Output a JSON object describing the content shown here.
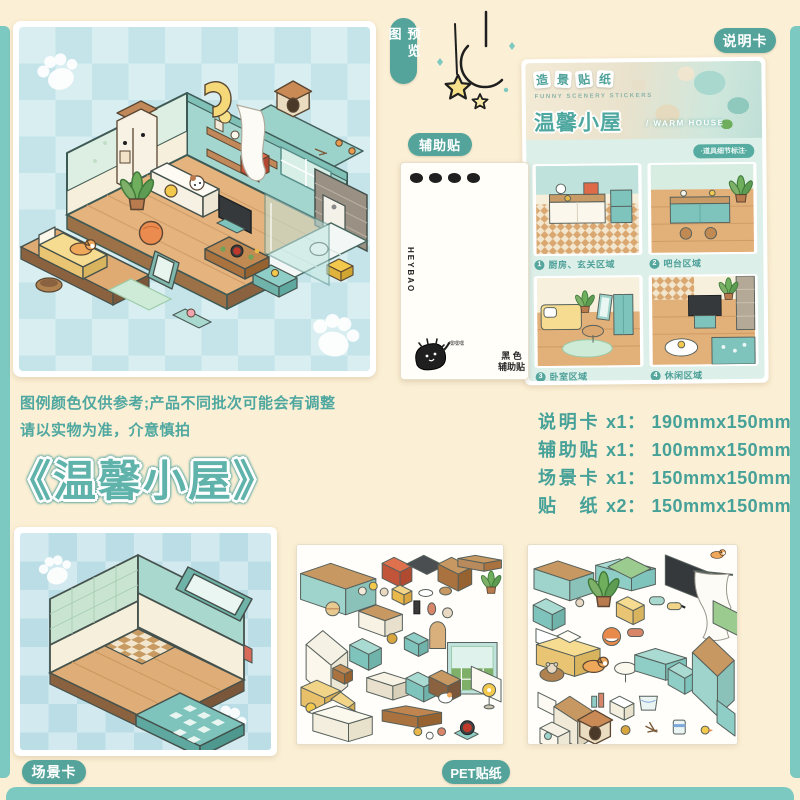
{
  "colors": {
    "page_bg": "#FBEFD5",
    "frame_teal": "#7CC9C1",
    "badge_teal": "#54A49B",
    "text_teal": "#46A199",
    "title_teal": "#5FB3AB"
  },
  "preview": {
    "badge": "预览图"
  },
  "instruction": {
    "badge": "说明卡",
    "series_chars": [
      "造",
      "景",
      "贴",
      "纸"
    ],
    "series_en": "FUNNY SCENERY STICKERS",
    "title": "温馨小屋",
    "title_en": "/ WARM HOUSE",
    "note": "·道具细节标注·",
    "regions": [
      {
        "num": "1",
        "label": "厨房、玄关区域"
      },
      {
        "num": "2",
        "label": "吧台区域"
      },
      {
        "num": "3",
        "label": "卧室区域"
      },
      {
        "num": "4",
        "label": "休闲区域"
      }
    ]
  },
  "auxiliary": {
    "badge": "辅助贴",
    "brand": "HEYBAO",
    "black_label": "黑 色\n辅助贴",
    "mascot_say": "嘿嘿嘿"
  },
  "disclaimer": {
    "line1": "图例颜色仅供参考;产品不同批次可能会有调整",
    "line2": "请以实物为准，介意慎拍"
  },
  "main_title": "《温馨小屋》",
  "specs": [
    {
      "name": "说明卡",
      "qty": "x1：",
      "size": "190mmx150mm"
    },
    {
      "name": "辅助贴",
      "qty": "x1：",
      "size": "100mmx150mm"
    },
    {
      "name": "场景卡",
      "qty": "x1：",
      "size": "150mmx150mm"
    },
    {
      "name": "贴纸",
      "qty": "x2：",
      "size": "150mmx150mm"
    }
  ],
  "scene": {
    "badge": "场景卡"
  },
  "stickers": {
    "badge": "PET贴纸"
  }
}
